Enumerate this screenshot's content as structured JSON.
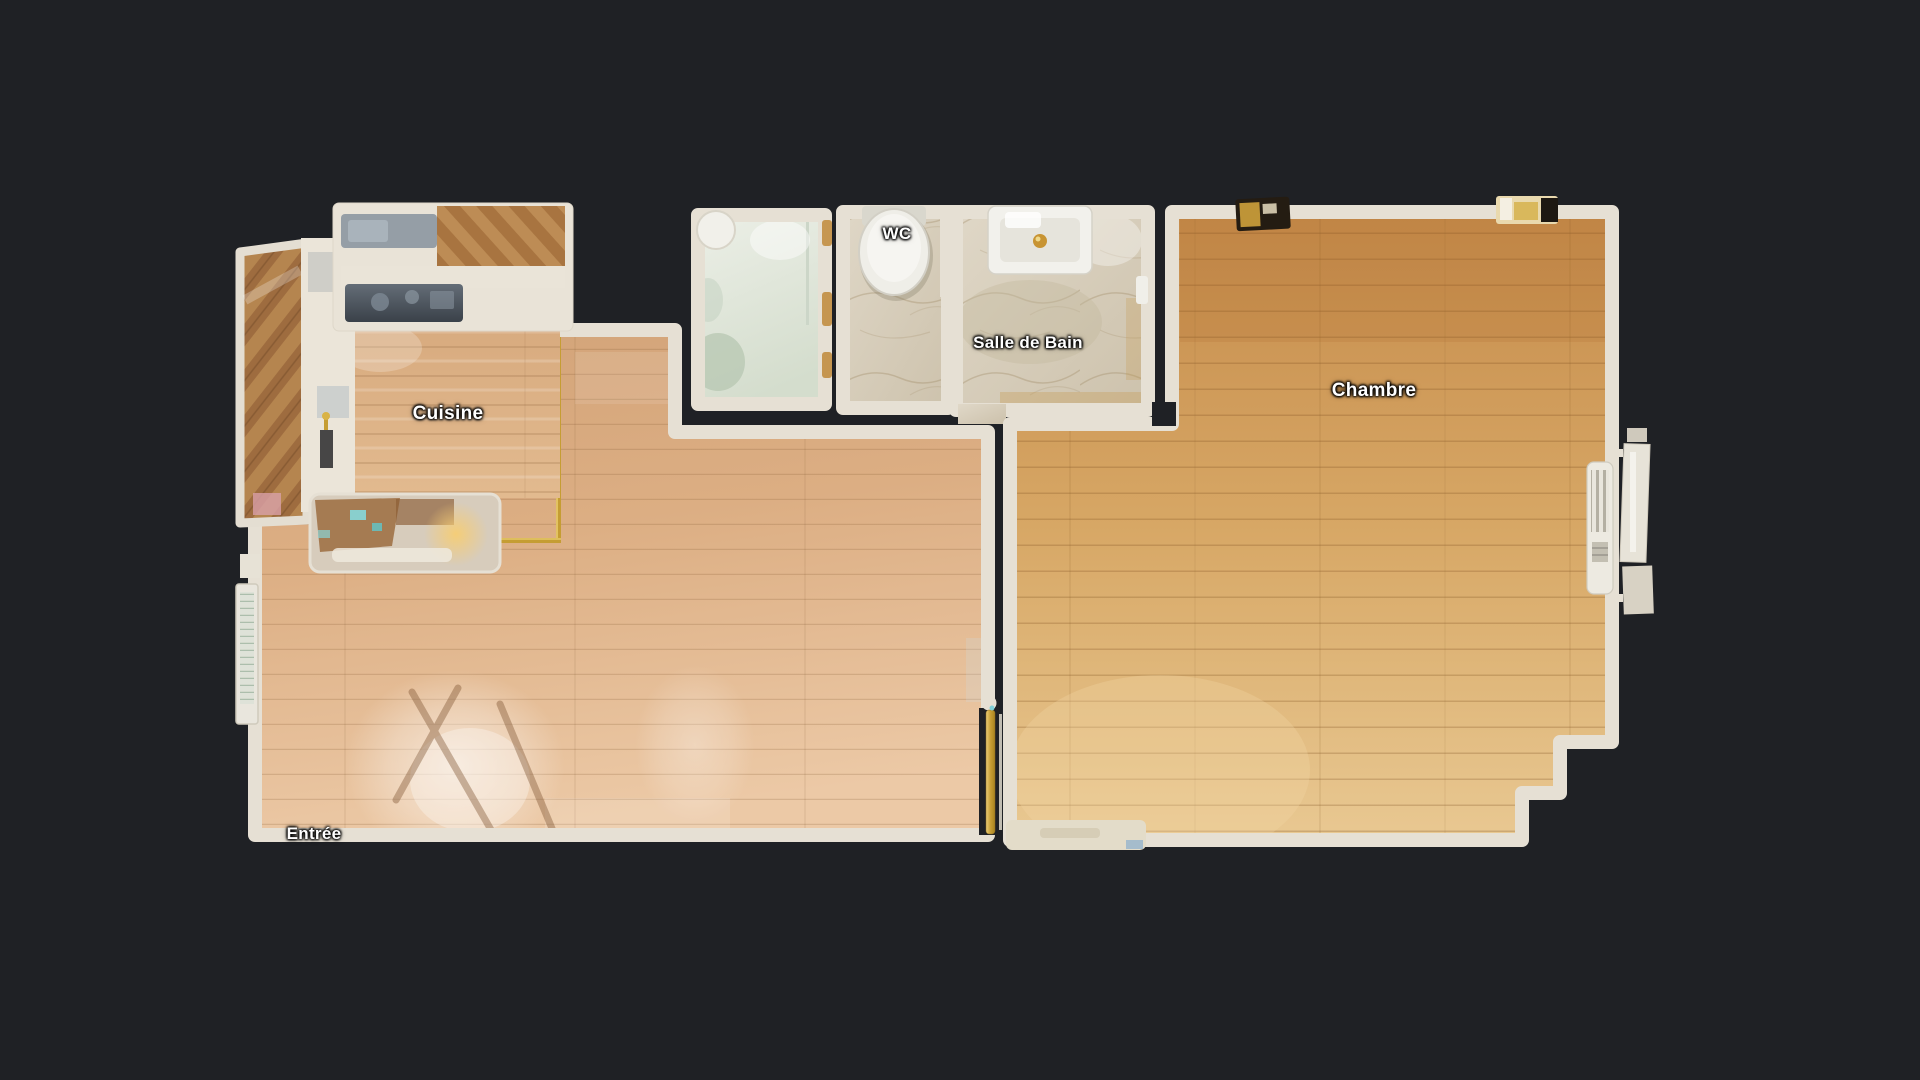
{
  "scene": {
    "type": "floor-plan",
    "background_color": "#1f2125"
  },
  "rooms": [
    {
      "id": "cuisine",
      "label": "Cuisine",
      "x": 448,
      "y": 414
    },
    {
      "id": "wc",
      "label": "WC",
      "x": 897,
      "y": 234
    },
    {
      "id": "salle-de-bain",
      "label": "Salle de Bain",
      "x": 1028,
      "y": 343
    },
    {
      "id": "chambre",
      "label": "Chambre",
      "x": 1374,
      "y": 391
    },
    {
      "id": "entree",
      "label": "Entrée",
      "x": 314,
      "y": 834
    }
  ],
  "colors": {
    "background": "#1f2125",
    "walls": "#e6e0d4",
    "living_floor": "#dfb28a",
    "bedroom_floor": "#d7a765",
    "kitchen_floor": "#ddb088",
    "marble_floor": "#d6cdbb",
    "shower_floor": "#e2e8da",
    "gold_accents": "#c59d33",
    "label_text": "#ffffff"
  },
  "fixtures": [
    "toilet",
    "bathroom-sink",
    "gold-faucet",
    "shower",
    "water-heater-column",
    "radiator",
    "window-bay",
    "entry-door",
    "kitchen-counter",
    "kitchen-sink",
    "cooktop",
    "island-counter",
    "tall-cabinet",
    "open-door-leaf",
    "threshold-strip",
    "wall-decor"
  ]
}
